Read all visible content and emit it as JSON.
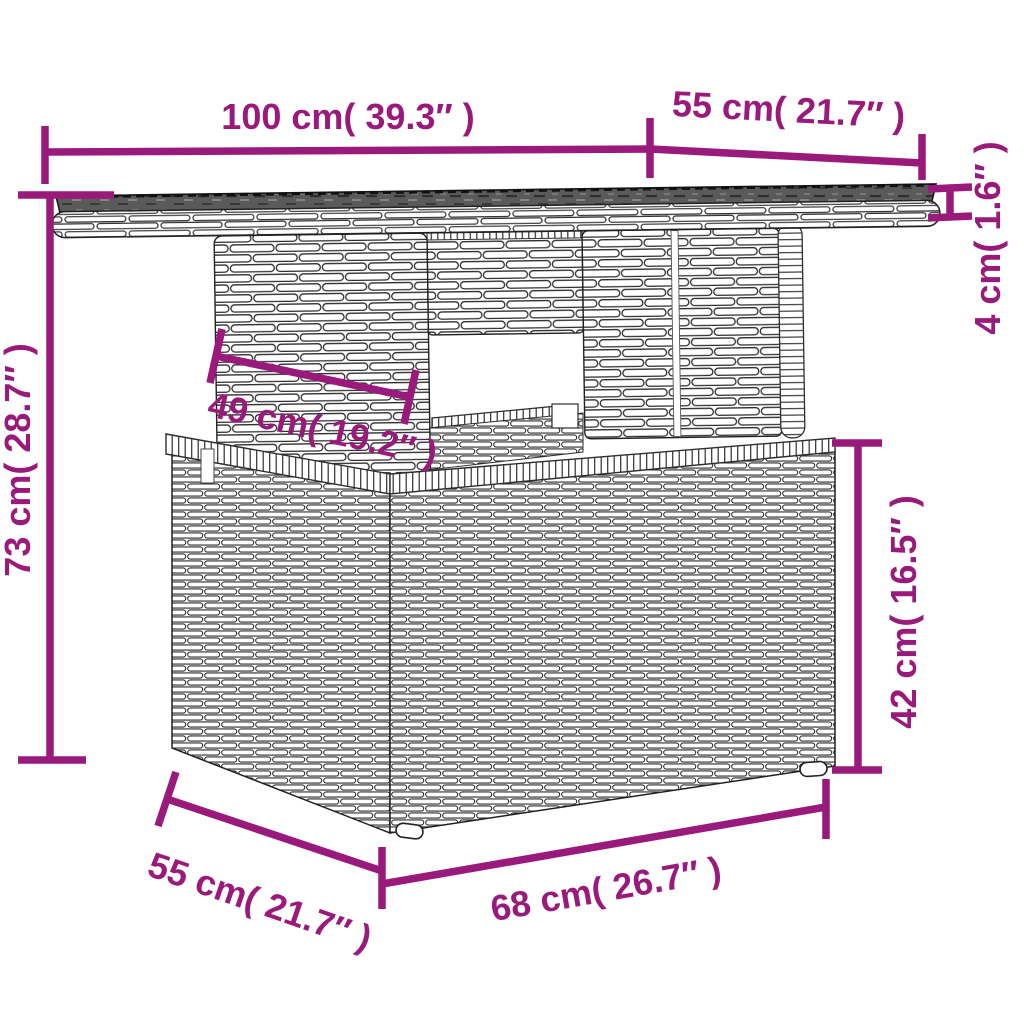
{
  "diagram": {
    "kind": "product-dimension-diagram",
    "subject": "poly-rattan garden table with storage base",
    "background_color": "#ffffff"
  },
  "colors": {
    "dimension_accent": "#9a1a7c",
    "line_art": "#2e2e2e",
    "tabletop_surface": "#5a5a5a"
  },
  "labels": {
    "top_width": "100 cm( 39.3″ )",
    "top_depth": "55 cm( 21.7″ )",
    "top_thickness": "4 cm( 1.6″ )",
    "leg_panel_width": "49 cm( 19.2″ )",
    "overall_height": "73 cm( 28.7″ )",
    "base_height": "42 cm( 16.5″ )",
    "base_depth": "55 cm( 21.7″ )",
    "base_width": "68 cm( 26.7″ )"
  }
}
